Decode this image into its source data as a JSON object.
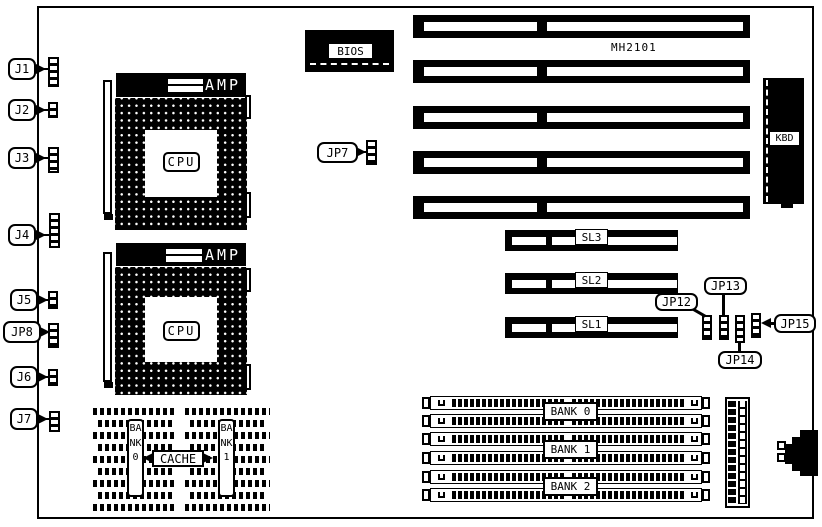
{
  "connectors_left": [
    {
      "label": "J1"
    },
    {
      "label": "J2"
    },
    {
      "label": "J3"
    },
    {
      "label": "J4"
    },
    {
      "label": "J5"
    },
    {
      "label": "JP8"
    },
    {
      "label": "J6"
    },
    {
      "label": "J7"
    }
  ],
  "cpu": {
    "socket_brand": "AMP",
    "chip_label": "CPU"
  },
  "bios": {
    "label": "BIOS"
  },
  "jp7": {
    "label": "JP7"
  },
  "chipset_label": "MH2101",
  "kbd": {
    "label": "KBD"
  },
  "sl_slots": [
    {
      "label": "SL3"
    },
    {
      "label": "SL2"
    },
    {
      "label": "SL1"
    }
  ],
  "jumpers_right": [
    {
      "label": "JP12"
    },
    {
      "label": "JP13"
    },
    {
      "label": "JP14"
    },
    {
      "label": "JP15"
    }
  ],
  "memory_banks": [
    {
      "label": "BANK 0"
    },
    {
      "label": "BANK 1"
    },
    {
      "label": "BANK 2"
    }
  ],
  "cache": {
    "label": "CACHE",
    "bank_left": "BANK0",
    "bank_right": "BANK1"
  },
  "isa_slot_count": 5,
  "colors": {
    "ink": "#000000",
    "paper": "#ffffff"
  }
}
